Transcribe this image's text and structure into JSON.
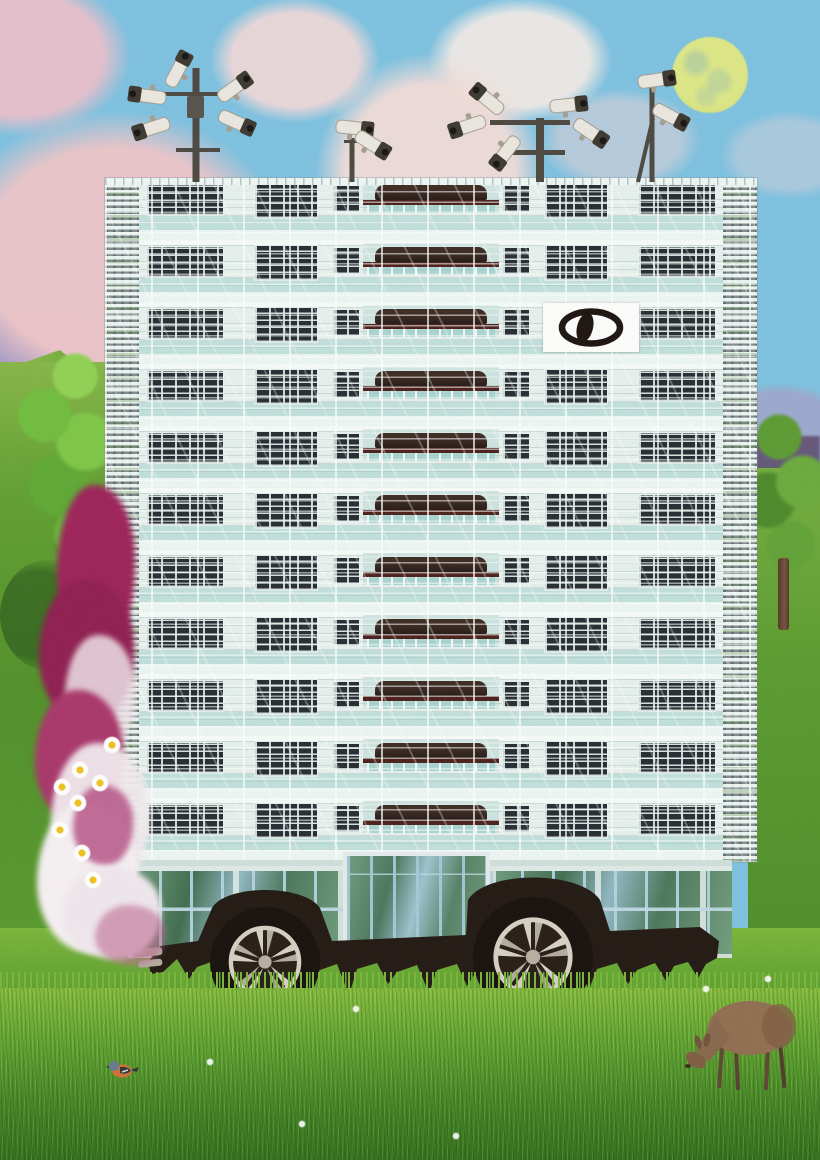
{
  "scene": {
    "title": "surreal-collage-tower-block-on-wheels",
    "palette": {
      "sky": "#7cc1e0",
      "cloud_pink": "#eec5c8",
      "cloud_white": "#f6ece6",
      "lavender": "#b08cba",
      "moon": "#dde784",
      "grass": "#58992c",
      "grass_dark": "#2f6d17",
      "building": "#e6f0ec",
      "window_dark": "#242a30",
      "maroon": "#4a1d18",
      "flower_magenta": "#9c2057",
      "flower_white": "#f3eef0",
      "daisy_center": "#eec11b",
      "chassis": "#201610",
      "rim": "#d6cfc2",
      "pole": "#4a463e",
      "cam_body": "#eae7df",
      "cam_dark": "#3a362e",
      "cam_shade": "#a39d8f",
      "deer_brown": "#8f6c4e",
      "bird_orange": "#cf6e35",
      "logo_bg": "#fdfdfb",
      "logo_ink": "#1a100c"
    },
    "sky": {
      "clouds": [
        {
          "x": 115,
          "y": 255,
          "rx": 235,
          "ry": 195,
          "c": "#eec5c8",
          "a": 0.95
        },
        {
          "x": 20,
          "y": 55,
          "rx": 150,
          "ry": 110,
          "c": "#f0bfca",
          "a": 0.9
        },
        {
          "x": 295,
          "y": 60,
          "rx": 115,
          "ry": 85,
          "c": "#f3d9d8",
          "a": 0.9
        },
        {
          "x": 430,
          "y": 175,
          "rx": 155,
          "ry": 165,
          "c": "#f2dcd8",
          "a": 0.95
        },
        {
          "x": 520,
          "y": 60,
          "rx": 125,
          "ry": 85,
          "c": "#f6ece6",
          "a": 0.9
        },
        {
          "x": 620,
          "y": 140,
          "rx": 110,
          "ry": 70,
          "c": "#edd3d6",
          "a": 0.5
        },
        {
          "x": 790,
          "y": 155,
          "rx": 95,
          "ry": 60,
          "c": "#e9d4da",
          "a": 0.4
        },
        {
          "x": 40,
          "y": 345,
          "rx": 125,
          "ry": 58,
          "c": "#b08cba",
          "a": 0.75
        },
        {
          "x": 240,
          "y": 330,
          "rx": 185,
          "ry": 120,
          "c": "#eecacb",
          "a": 0.8
        },
        {
          "x": 780,
          "y": 420,
          "rx": 90,
          "ry": 50,
          "c": "#b493bd",
          "a": 0.55
        }
      ]
    },
    "moon": {
      "x": 672,
      "y": 37,
      "d": 76
    },
    "building": {
      "x": 105,
      "y": 178,
      "w": 652,
      "h": 684,
      "floors": 11,
      "floor_h": 62,
      "window_blocks": [
        {
          "x": 42,
          "w": 76,
          "h": 30,
          "t": 7
        },
        {
          "x": 150,
          "w": 62,
          "h": 34,
          "t": 6
        },
        {
          "x": 228,
          "w": 26,
          "h": 26,
          "t": 8
        }
      ],
      "car_band": {
        "x": 258,
        "w": 136,
        "h": 32,
        "t": 3
      },
      "logo": {
        "x": 543,
        "y": 303,
        "w": 96,
        "h": 49
      }
    },
    "ground_floor": {
      "x": 128,
      "y": 860,
      "w": 604,
      "h": 98,
      "portico": {
        "x": 215,
        "w": 147
      }
    },
    "cameras": {
      "clusters": [
        {
          "pole": {
            "x": 196,
            "y1": 68,
            "y2": 182,
            "w": 7
          },
          "arms": [
            {
              "x": 158,
              "y": 92,
              "w": 76,
              "h": 4
            },
            {
              "x": 176,
              "y": 148,
              "w": 44,
              "h": 4
            }
          ],
          "box": {
            "x": 187,
            "y": 96,
            "w": 17,
            "h": 22
          },
          "cams": [
            {
              "x": 178,
              "y": 70,
              "rot": -62
            },
            {
              "x": 234,
              "y": 88,
              "rot": -36
            },
            {
              "x": 148,
              "y": 96,
              "rot": 188
            },
            {
              "x": 152,
              "y": 128,
              "rot": 162
            },
            {
              "x": 236,
              "y": 122,
              "rot": 24
            }
          ]
        },
        {
          "pole": {
            "x": 352,
            "y1": 138,
            "y2": 182,
            "w": 5
          },
          "arms": [
            {
              "x": 344,
              "y": 140,
              "w": 30,
              "h": 3
            }
          ],
          "cams": [
            {
              "x": 354,
              "y": 128,
              "rot": 6
            },
            {
              "x": 372,
              "y": 144,
              "rot": 32
            }
          ]
        },
        {
          "pole": {
            "x": 540,
            "y1": 118,
            "y2": 182,
            "w": 8
          },
          "arms": [
            {
              "x": 490,
              "y": 120,
              "w": 80,
              "h": 5
            },
            {
              "x": 505,
              "y": 150,
              "w": 60,
              "h": 5
            }
          ],
          "cams": [
            {
              "x": 488,
              "y": 100,
              "rot": -140
            },
            {
              "x": 468,
              "y": 126,
              "rot": 162
            },
            {
              "x": 506,
              "y": 152,
              "rot": 128
            },
            {
              "x": 568,
              "y": 105,
              "rot": -6
            },
            {
              "x": 590,
              "y": 132,
              "rot": 34
            }
          ]
        },
        {
          "pole": {
            "x": 652,
            "y1": 82,
            "y2": 182,
            "w": 5
          },
          "strut": {
            "x1": 638,
            "y1": 182,
            "x2": 653,
            "y2": 118
          },
          "cams": [
            {
              "x": 656,
              "y": 80,
              "rot": -8
            },
            {
              "x": 670,
              "y": 116,
              "rot": 28
            }
          ]
        }
      ]
    },
    "chassis": {
      "path": "M148,962 L160,946 L198,941 L212,908 C226,884 304,884 320,908 L332,941 L466,935 L468,900 C486,870 580,870 600,900 L610,931 L700,927 L719,941 L717,958 L706,964 L698,978 L688,962 L674,966 L666,981 L655,963 L637,970 L628,984 L617,963 L597,969 L589,989 L577,964 L556,971 L547,983 L537,965 L517,970 L509,992 L497,966 L476,972 L467,986 L457,964 L437,970 L429,993 L417,965 L397,972 L388,984 L377,963 L357,969 L349,995 L337,964 L317,971 L308,984 L297,962 L277,969 L269,991 L257,963 L237,969 L228,981 L217,960 L197,967 L189,979 L177,959 L163,972 L151,974 Z",
      "exhaust": [
        {
          "x": 132,
          "y": 950,
          "w": 30,
          "h": 8
        },
        {
          "x": 138,
          "y": 961,
          "w": 24,
          "h": 7
        }
      ]
    },
    "wheels": [
      {
        "cx": 265,
        "cy": 962,
        "r": 55
      },
      {
        "cx": 533,
        "cy": 957,
        "r": 60
      }
    ],
    "flowers": {
      "x": 35,
      "y": 485,
      "w": 115,
      "h": 475,
      "blobs": [
        {
          "x": 22,
          "y": 0,
          "w": 78,
          "h": 165,
          "c": "#9c2057"
        },
        {
          "x": 4,
          "y": 95,
          "w": 95,
          "h": 145,
          "c": "#8e1c4e"
        },
        {
          "x": 30,
          "y": 150,
          "w": 70,
          "h": 120,
          "c": "#efe2e8",
          "o": 0.85
        },
        {
          "x": 0,
          "y": 205,
          "w": 88,
          "h": 135,
          "c": "#a83468"
        },
        {
          "x": 16,
          "y": 258,
          "w": 98,
          "h": 150,
          "c": "#f2eaee",
          "o": 0.95
        },
        {
          "x": 2,
          "y": 318,
          "w": 100,
          "h": 150,
          "c": "#f6f0f3"
        },
        {
          "x": 38,
          "y": 300,
          "w": 60,
          "h": 80,
          "c": "#b2487e",
          "o": 0.8
        },
        {
          "x": 28,
          "y": 382,
          "w": 98,
          "h": 92,
          "c": "#efe7ec"
        },
        {
          "x": 60,
          "y": 420,
          "w": 70,
          "h": 60,
          "c": "#c06a92",
          "o": 0.6
        }
      ],
      "daisies": [
        [
          112,
          745
        ],
        [
          80,
          770
        ],
        [
          100,
          783
        ],
        [
          62,
          787
        ],
        [
          78,
          803
        ],
        [
          60,
          830
        ],
        [
          82,
          853
        ],
        [
          93,
          880
        ]
      ]
    },
    "lawn_specks": [
      [
        352,
        1005
      ],
      [
        298,
        1120
      ],
      [
        702,
        985
      ],
      [
        764,
        975
      ],
      [
        206,
        1058
      ],
      [
        452,
        1132
      ]
    ],
    "animals": {
      "deer": {
        "x": 662,
        "y": 986
      },
      "bird": {
        "x": 106,
        "y": 1058
      }
    }
  }
}
